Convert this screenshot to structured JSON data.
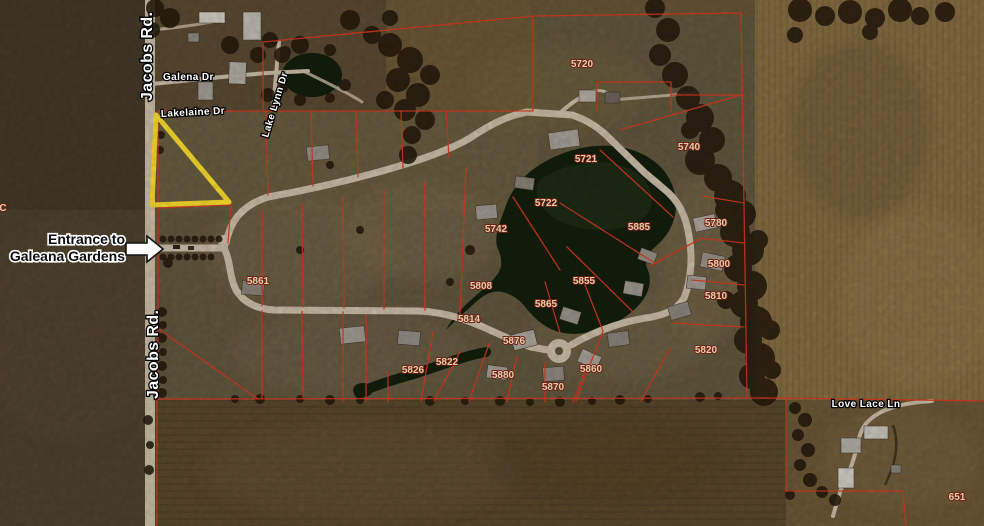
{
  "title": "Aerial plat map of Galeana Gardens subdivision",
  "streets": {
    "jacobs_top": "Jacobs Rd.",
    "jacobs_bottom": "Jacobs Rd.",
    "galena": "Galena Dr",
    "lakelaine": "Lakelaine Dr",
    "lake_lynn": "Lake Lynn Dr",
    "love_lace": "Love Lace Ln"
  },
  "annotation": {
    "line1": "Entrance to",
    "line2": "Galeana Gardens"
  },
  "lots": [
    {
      "n": "5720",
      "x": 582,
      "y": 67
    },
    {
      "n": "5721",
      "x": 586,
      "y": 162
    },
    {
      "n": "5740",
      "x": 689,
      "y": 150
    },
    {
      "n": "5722",
      "x": 546,
      "y": 206
    },
    {
      "n": "5742",
      "x": 496,
      "y": 232
    },
    {
      "n": "5885",
      "x": 639,
      "y": 230
    },
    {
      "n": "5780",
      "x": 716,
      "y": 226
    },
    {
      "n": "5800",
      "x": 719,
      "y": 267
    },
    {
      "n": "5810",
      "x": 716,
      "y": 299
    },
    {
      "n": "5820",
      "x": 706,
      "y": 353
    },
    {
      "n": "5855",
      "x": 584,
      "y": 284
    },
    {
      "n": "5865",
      "x": 546,
      "y": 307
    },
    {
      "n": "5808",
      "x": 481,
      "y": 289
    },
    {
      "n": "5861",
      "x": 258,
      "y": 284
    },
    {
      "n": "5814",
      "x": 469,
      "y": 322
    },
    {
      "n": "5876",
      "x": 514,
      "y": 344
    },
    {
      "n": "5822",
      "x": 447,
      "y": 365
    },
    {
      "n": "5826",
      "x": 413,
      "y": 373
    },
    {
      "n": "5880",
      "x": 503,
      "y": 378
    },
    {
      "n": "5870",
      "x": 553,
      "y": 390
    },
    {
      "n": "5860",
      "x": 591,
      "y": 372
    }
  ],
  "parcel_651": {
    "text": "651",
    "x": 957,
    "y": 500
  },
  "edge_watermark": "C",
  "colors": {
    "lot_line": "#e23b24",
    "highlight": "#ffe22e",
    "road": "#cfc3ac",
    "water": "#141f0d",
    "lot_label": "#ecd2b0",
    "street_label": "#ffffff"
  }
}
